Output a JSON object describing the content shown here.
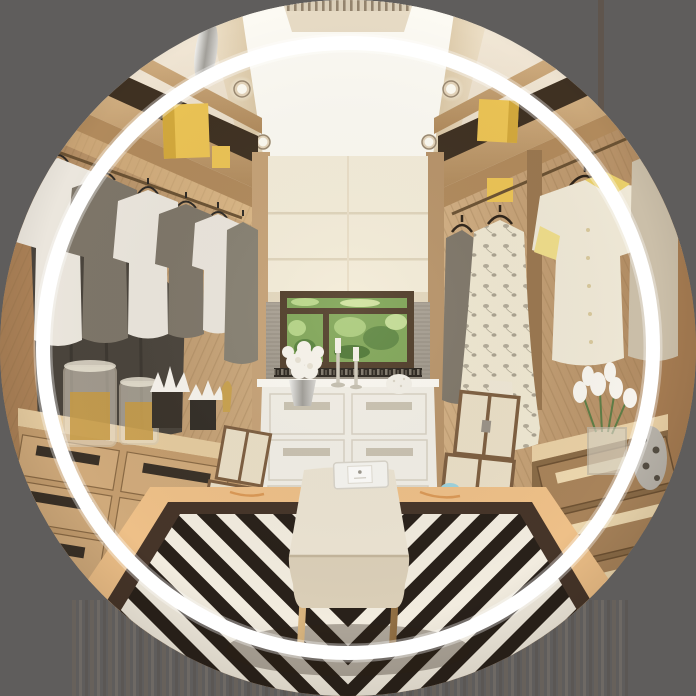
{
  "image": {
    "type": "circular-masked-photo",
    "alt": "Walk-in closet interior with wooden wardrobes, hanging clothes, white dresser, window, bench and black-and-white striped rug, cropped in a circle with a white inner ring",
    "width": 696,
    "height": 696,
    "ring": {
      "radius": 305,
      "thickness": 14
    }
  },
  "palette": {
    "bg": "#5f5d5c",
    "ring": "#ffffff",
    "ceiling": "#efe5d3",
    "ceiling-panel": "#fcfaf3",
    "alcove-shade": "#f4edda",
    "wallpaper": "#9b948a",
    "window-frame": "#4e3b28",
    "foliage": "#7ea557",
    "dresser": "#f2efe7",
    "yellow-box": "#ecc455",
    "shirt-white": "#ebe6dd",
    "shirt-olive": "#7e7669",
    "garment-dark": "#4a443c",
    "clothes-cream": "#efe8d6",
    "trunk": "#eadfc7",
    "trunk-trim": "#7d5e40",
    "flower-white": "#f7f4ed",
    "bench": "#ece4d3",
    "gold": "#c09a68",
    "marble": "#eec088",
    "floor-wood": "#e2c096",
    "rug-black": "#29211a",
    "rug-white": "#f2ecdf",
    "rug-border": "#463529",
    "wood": "#c29b6e",
    "wood-dark": "#a07c52",
    "wood-light": "#d9b88c",
    "glass-amber": "#c79a43",
    "silver": "#c9c9c7"
  },
  "labels": {
    "photo": "walk-in closet photo",
    "ring": "white circular ring overlay",
    "ceiling": "cream cove ceiling with recessed spotlights",
    "left_wardrobe": "left oak wardrobe with grey and white shirts",
    "right_wardrobe": "right oak wardrobe with cream clothes",
    "dresser": "white eight-drawer dresser with flowers and candlesticks",
    "window": "window with green foliage above dresser",
    "bench": "cream upholstered bench with brass legs",
    "rug": "black and white geometric striped rug",
    "trunks": "stacked cream travel trunks with leather trim"
  }
}
